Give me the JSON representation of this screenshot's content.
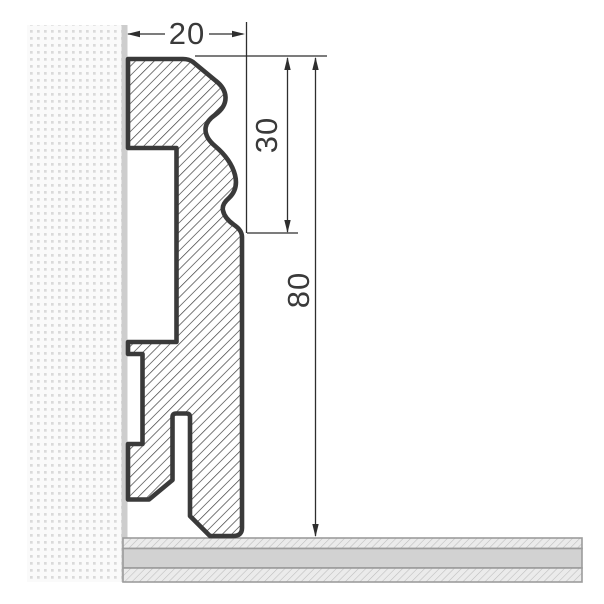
{
  "diagram": {
    "kind": "technical cross-section drawing of a skirting board profile against a wall and floor",
    "dimensions": {
      "width": {
        "label": "20"
      },
      "upper_height": {
        "label": "30"
      },
      "total_height": {
        "label": "80"
      }
    },
    "colors": {
      "outline": "#3a3a3a",
      "hatch": "#404040",
      "text": "#3a3a3a",
      "dimension_line": "#2e2e2e",
      "wall_strip": "#cdcdcd",
      "wall_dot": "#dadada",
      "wall_bg": "#fafafa",
      "floor_fill": "#d2d2d2",
      "floor_hatch_bg": "#ebebeb",
      "floor_hatch_line": "#bcbcbc",
      "floor_border": "#9c9c9c"
    }
  }
}
